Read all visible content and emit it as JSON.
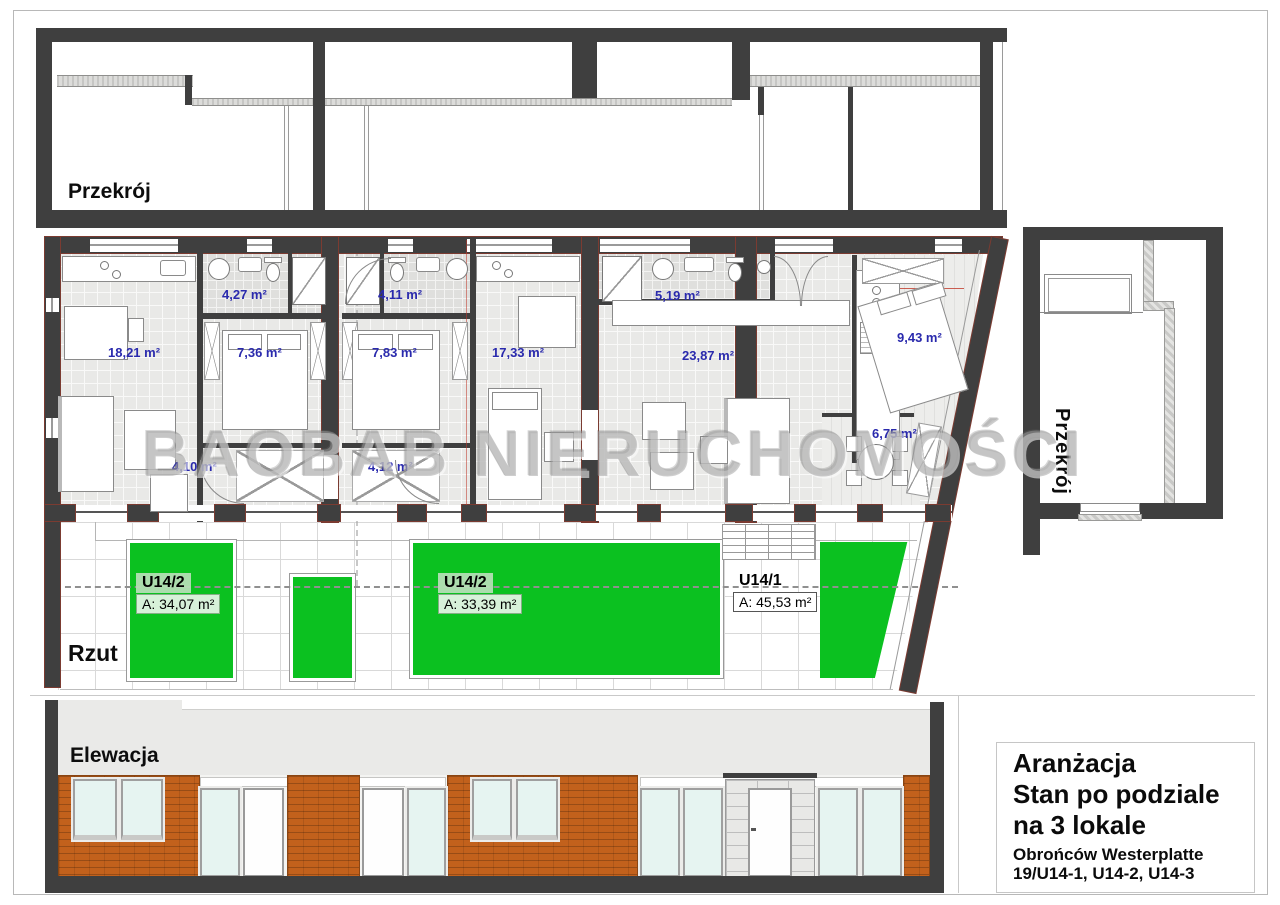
{
  "watermark": {
    "text": "BAOBAB NIERUCHOMOŚCI"
  },
  "labels": {
    "top_section": "Przekrój",
    "right_section": "Przekrój",
    "plan": "Rzut",
    "elevation": "Elewacja"
  },
  "floor_plan": {
    "rooms": [
      {
        "label": "18,21 m²",
        "x": 108,
        "y": 345
      },
      {
        "label": "4,27 m²",
        "x": 222,
        "y": 287
      },
      {
        "label": "7,36 m²",
        "x": 237,
        "y": 345
      },
      {
        "label": "4,11 m²",
        "x": 378,
        "y": 287
      },
      {
        "label": "7,83 m²",
        "x": 372,
        "y": 345
      },
      {
        "label": "17,33 m²",
        "x": 492,
        "y": 345
      },
      {
        "label": "5,19 m²",
        "x": 655,
        "y": 288
      },
      {
        "label": "23,87 m²",
        "x": 682,
        "y": 348
      },
      {
        "label": "9,43 m²",
        "x": 897,
        "y": 330
      },
      {
        "label": "6,75 m²",
        "x": 872,
        "y": 426
      },
      {
        "label": "4,10 m²",
        "x": 172,
        "y": 459
      },
      {
        "label": "4,12 m²",
        "x": 368,
        "y": 459
      }
    ],
    "units": [
      {
        "name": "U14/2",
        "area": "A: 34,07 m²",
        "x": 136,
        "y": 573,
        "chip": true
      },
      {
        "name": "U14/2",
        "area": "A: 33,39 m²",
        "x": 438,
        "y": 573,
        "chip": true
      },
      {
        "name": "U14/1",
        "area": "A: 45,53 m²",
        "x": 733,
        "y": 571,
        "chip": false
      }
    ]
  },
  "title_block": {
    "line1": "Aranżacja",
    "line2": "Stan po podziale",
    "line3": "na 3 lokale",
    "line4": "Obrońców Westerplatte",
    "line5": "19/U14-1, U14-2, U14-3"
  },
  "colors": {
    "wall": "#3f3f3f",
    "wall_outline": "#7b3b31",
    "green": "#0bc120",
    "brick": "#c2611c",
    "glass": "#e6f4f1",
    "room_label_blue": "#2a2aad",
    "watermark_gray": "#9e9e9e"
  }
}
